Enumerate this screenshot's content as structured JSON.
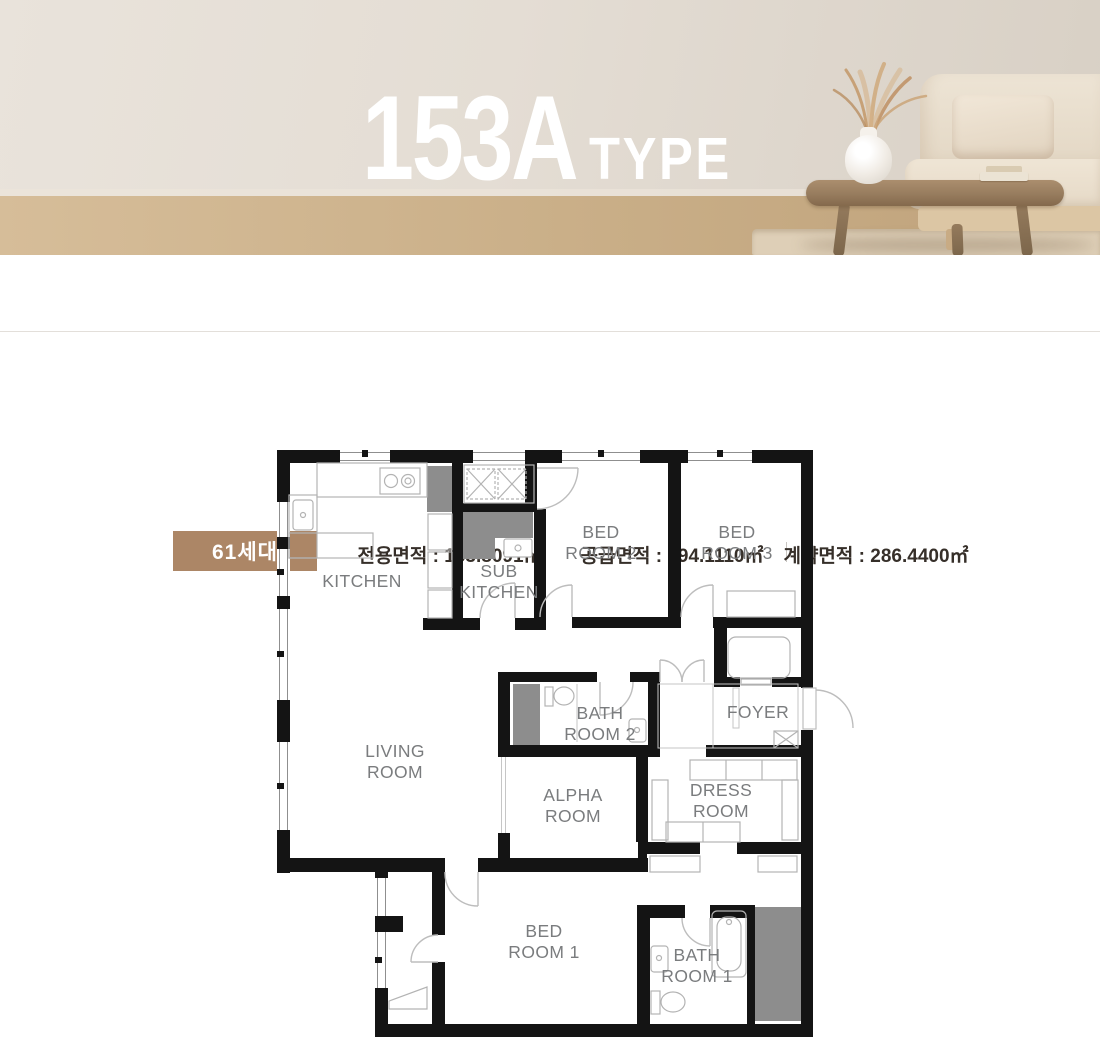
{
  "hero": {
    "title": "153A",
    "subtitle": "TYPE"
  },
  "info_bar": {
    "badge": "61세대",
    "badge_color": "#ac8666",
    "separator": " : ",
    "items": [
      {
        "label": "전용면적",
        "value": "153.8091㎡"
      },
      {
        "label": "공급면적",
        "value": "194.1110㎡"
      },
      {
        "label": "계약면적",
        "value": "286.4400㎡"
      }
    ]
  },
  "floor_plan": {
    "wall_color": "#141414",
    "duct_color": "#8d8d8d",
    "label_color": "#7a7c7e",
    "door_color": "#bdbdbd",
    "fixture_color": "#b3b3b3",
    "labels": {
      "kitchen": "KITCHEN",
      "sub_kitchen_1": "SUB",
      "sub_kitchen_2": "KITCHEN",
      "bed2_1": "BED",
      "bed2_2": "ROOM 2",
      "bed3_1": "BED",
      "bed3_2": "ROOM 3",
      "living_1": "LIVING",
      "living_2": "ROOM",
      "bath2_1": "BATH",
      "bath2_2": "ROOM 2",
      "foyer": "FOYER",
      "alpha_1": "ALPHA",
      "alpha_2": "ROOM",
      "dress_1": "DRESS",
      "dress_2": "ROOM",
      "bed1_1": "BED",
      "bed1_2": "ROOM 1",
      "bath1_1": "BATH",
      "bath1_2": "ROOM 1"
    }
  }
}
